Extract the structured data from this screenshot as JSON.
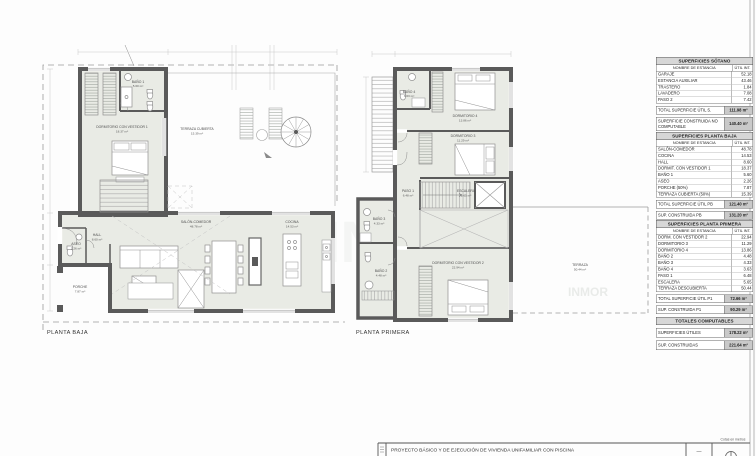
{
  "sheet": {
    "watermark_large": "INMO",
    "watermark_small": "INMOR"
  },
  "plans": {
    "baja": {
      "label": "PLANTA BAJA",
      "rooms": {
        "dorm1": {
          "name": "DORMITORIO CON VESTIDOR 1",
          "area": "18.37 m²"
        },
        "bano1": {
          "name": "BAÑO 1",
          "area": "5.60 m²"
        },
        "terraza": {
          "name": "TERRAZA CUBIERTA",
          "area": "15.39 m²"
        },
        "salon": {
          "name": "SALÓN-COMEDOR",
          "area": "48.78 m²"
        },
        "cocina": {
          "name": "COCINA",
          "area": "14.53 m²"
        },
        "hall": {
          "name": "HALL",
          "area": "8.60 m²"
        },
        "aseo": {
          "name": "ASEO",
          "area": "2.26 m²"
        },
        "porche": {
          "name": "PORCHE",
          "area": "7.87 m²"
        }
      }
    },
    "primera": {
      "label": "PLANTA PRIMERA",
      "rooms": {
        "bano4": {
          "name": "BAÑO 4",
          "area": "3.63 m²"
        },
        "dorm4": {
          "name": "DORMITORIO 4",
          "area": "13.86 m²"
        },
        "dorm3": {
          "name": "DORMITORIO 3",
          "area": "11.29 m²"
        },
        "paso1": {
          "name": "PASO 1",
          "area": "6.48 m²"
        },
        "escalera": {
          "name": "ESCALERA",
          "area": "5.65 m²"
        },
        "bano3": {
          "name": "BAÑO 3",
          "area": "4.33 m²"
        },
        "bano2": {
          "name": "BAÑO 2",
          "area": "4.48 m²"
        },
        "dorm2": {
          "name": "DORMITORIO CON VESTIDOR 2",
          "area": "22.94 m²"
        },
        "terraza": {
          "name": "TERRAZA",
          "area": "50.44 m²"
        }
      }
    }
  },
  "tables": {
    "sotano": {
      "title": "SUPERFICIES SÓTANO",
      "col_name": "NOMBRE DE ESTANCIA",
      "col_value": "ÚTIL INT.",
      "rows": [
        {
          "name": "GARAJE",
          "value": "52.18"
        },
        {
          "name": "ESTANCIA AUXILIAR",
          "value": "43.46"
        },
        {
          "name": "TRASTERO",
          "value": "1.84"
        },
        {
          "name": "LAVADERO",
          "value": "7.08"
        },
        {
          "name": "PASO 2",
          "value": "7.42"
        }
      ],
      "total_label": "TOTAL SUPERFICIE ÚTIL S.",
      "total_value": "111.98 m²",
      "extra_label": "SUPERFICIE CONSTRUIDA NO COMPUTABLE",
      "extra_value": "140.40 m²"
    },
    "planta_baja": {
      "title": "SUPERFICIES  PLANTA BAJA",
      "col_name": "NOMBRE DE ESTANCIA",
      "col_value": "ÚTIL INT.",
      "rows": [
        {
          "name": "SALÓN-COMEDOR",
          "value": "48.78"
        },
        {
          "name": "COCINA",
          "value": "14.53"
        },
        {
          "name": "HALL",
          "value": "8.60"
        },
        {
          "name": "DORMIT. CON VESTIDOR 1",
          "value": "18.37"
        },
        {
          "name": "BAÑO 1",
          "value": "5.60"
        },
        {
          "name": "ASEO",
          "value": "2.26"
        },
        {
          "name": "PORCHE (50%)",
          "value": "7.87"
        },
        {
          "name": "TERRAZA CUBIERTA (50%)",
          "value": "15.39"
        }
      ],
      "total_label": "TOTAL SUPERFICIE ÚTIL PB",
      "total_value": "121.40 m²",
      "extra_label": "SUP. CONSTRUIDA PB",
      "extra_value": "131.20 m²"
    },
    "planta_primera": {
      "title": "SUPERFICIES PLANTA PRIMERA",
      "col_name": "NOMBRE DE ESTANCIA",
      "col_value": "ÚTIL INT.",
      "rows": [
        {
          "name": "DORM. CON VESTIDOR 2",
          "value": "22.94"
        },
        {
          "name": "DORMITORIO 3",
          "value": "11.29"
        },
        {
          "name": "DORMITORIO 4",
          "value": "13.86"
        },
        {
          "name": "BAÑO 2",
          "value": "4.48"
        },
        {
          "name": "BAÑO 3",
          "value": "4.33"
        },
        {
          "name": "BAÑO 4",
          "value": "3.63"
        },
        {
          "name": "PASO 1",
          "value": "6.48"
        },
        {
          "name": "ESCALERA",
          "value": "5.65"
        },
        {
          "name": "TERRAZA DESCUBIERTA",
          "value": "50.44"
        }
      ],
      "total_label": "TOTAL SUPERFICIE ÚTIL P1",
      "total_value": "72.66 m²",
      "extra_label": "SUP. CONSTRUIDA P1",
      "extra_value": "90.29 m²"
    },
    "totales": {
      "title": "TOTALES COMPUTABLES",
      "rows": [
        {
          "name": "SUPERFICIES ÚTILES",
          "value": "178.22 m²"
        },
        {
          "name": "SUP. CONSTRUIDAS",
          "value": "221.64 m²"
        }
      ]
    }
  },
  "titleblock": {
    "project": "PROYECTO BÁSICO Y DE EJECUCIÓN DE  VIVIENDA UNIFAMILIAR CON PISCINA",
    "note": "Cotas en metros",
    "dash": "—"
  }
}
